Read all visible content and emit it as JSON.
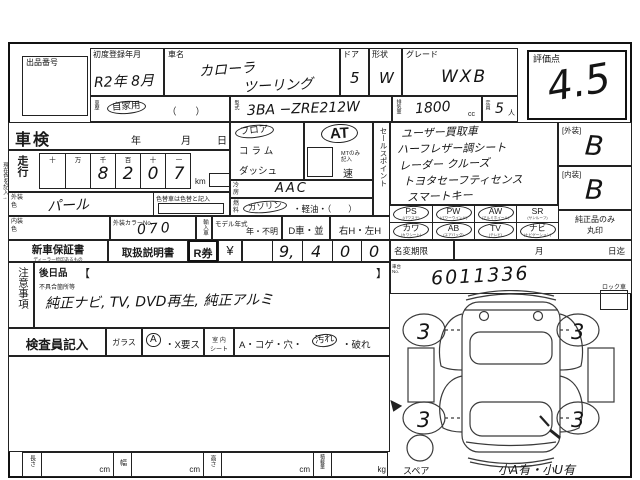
{
  "header": {
    "auction_no_label": "出品番号",
    "first_reg_label": "初度登録年月",
    "first_reg_value": "R2年 8月",
    "car_name_label": "車名",
    "car_name_line1": "カローラ",
    "car_name_line2": "ツーリング",
    "door_label": "ドア",
    "door_value": "5",
    "shape_label": "形状",
    "shape_value": "W",
    "grade_label": "グレード",
    "grade_value": "WXB",
    "score_label": "評価点",
    "score_value": "4.5",
    "history_label": "車歴",
    "history_value": "自家用",
    "history_paren": "（　　）",
    "model_code_label": "型式",
    "model_code_value": "3BA −ZRE212W",
    "disp_label": "排気量",
    "disp_value": "1800",
    "disp_unit": "cc",
    "capacity_label": "定員",
    "capacity_value": "5",
    "capacity_unit": "人"
  },
  "left": {
    "margin_note": "現在色を記入→",
    "shaken_label": "車検",
    "year_label": "年",
    "month_label": "月",
    "day_label": "日",
    "mileage_label": "走行",
    "mileage_cols": [
      "十",
      "万",
      "千",
      "百",
      "十",
      "一"
    ],
    "mileage_digits": [
      "",
      "",
      "8",
      "2",
      "0",
      "7"
    ],
    "km_label": "km",
    "ext_color_label": "外装色",
    "ext_color_value": "パール",
    "color_change_note": "色替車は色替と記入",
    "int_color_label": "内装色",
    "color_no_label": "外装カラーNo.",
    "color_no_value": "070",
    "import_label": "輸入車",
    "model_year_label": "モデル年式",
    "model_year_value": "年・不明",
    "d_car_label": "D車・並",
    "handle_label": "右H・左H"
  },
  "middle": {
    "shift_floor": "フロア",
    "shift_column": "コラム",
    "shift_dash": "ダッシュ",
    "at_value": "AT",
    "mt_note_1": "MTのみ",
    "mt_note_2": "記入",
    "speed_label": "速",
    "ac_label": "冷房",
    "ac_value": "AAC",
    "fuel_label": "燃料",
    "fuel_gasoline": "ガソリン",
    "fuel_rest": "・軽油・（　　）",
    "sales_point_label": "セールスポイント"
  },
  "sales_points": [
    "ユーザー買取車",
    "ハーフレザー調シート",
    "レーダー クルーズ",
    "トヨタセーフティセンス",
    "スマートキー"
  ],
  "equipment": [
    {
      "code": "PS",
      "sub": "(パワステ)",
      "checked": true
    },
    {
      "code": "PW",
      "sub": "(パワーウインド)",
      "checked": true
    },
    {
      "code": "AW",
      "sub": "(アルミホイール)",
      "checked": true
    },
    {
      "code": "SR",
      "sub": "(サンルーフ)",
      "checked": false
    },
    {
      "code": "カワ",
      "sub": "(カワシート)",
      "checked": true
    },
    {
      "code": "AB",
      "sub": "(エアバッグ)",
      "checked": true
    },
    {
      "code": "TV",
      "sub": "(テレビ)",
      "checked": true
    },
    {
      "code": "ナビ",
      "sub": "(ナビゲーション)",
      "checked": true
    }
  ],
  "grades": {
    "exterior_label": "[外装]",
    "exterior_value": "B",
    "interior_label": "[内装]",
    "interior_value": "B",
    "genuine_note_1": "純正品のみ",
    "genuine_note_2": "丸印"
  },
  "docs": {
    "warranty_label": "新車保証書",
    "warranty_sub": "ディーラー捺印あるもの",
    "manual_label": "取扱説明書",
    "r_ticket_label": "R券",
    "yen_label": "¥",
    "r_digits": [
      "9,",
      "4",
      "0",
      "0"
    ],
    "name_change_label": "名変期限",
    "month_label": "月",
    "day_until_label": "日迄"
  },
  "chassis": {
    "label_1": "車台",
    "label_2": "No.",
    "value": "6011336"
  },
  "notes": {
    "section_label": "注意事項",
    "later_label": "後日品",
    "bracket_open": "【",
    "bracket_close": "】",
    "defect_label": "不具合箇所等",
    "defect_value": "純正ナビ, TV, DVD再生, 純正アルミ"
  },
  "inspector": {
    "label": "検査員記入",
    "glass_label": "ガラス",
    "glass_a": "A",
    "glass_rest": "・X要ス",
    "seat_label_1": "室 内",
    "seat_label_2": "シート",
    "seat_pre": "A・コゲ・穴・",
    "seat_dirty": "汚れ",
    "seat_post": "・破れ"
  },
  "dimensions": {
    "length_label": "長さ",
    "width_label": "幅",
    "height_label": "高さ",
    "load_label": "積載量",
    "cm": "cm",
    "kg": "kg"
  },
  "diagram": {
    "lock_label": "ロック車",
    "wheel_marks": [
      "3",
      "3",
      "3",
      "3"
    ],
    "spare_label": "スペア",
    "bottom_note": "小A有・小U有"
  }
}
